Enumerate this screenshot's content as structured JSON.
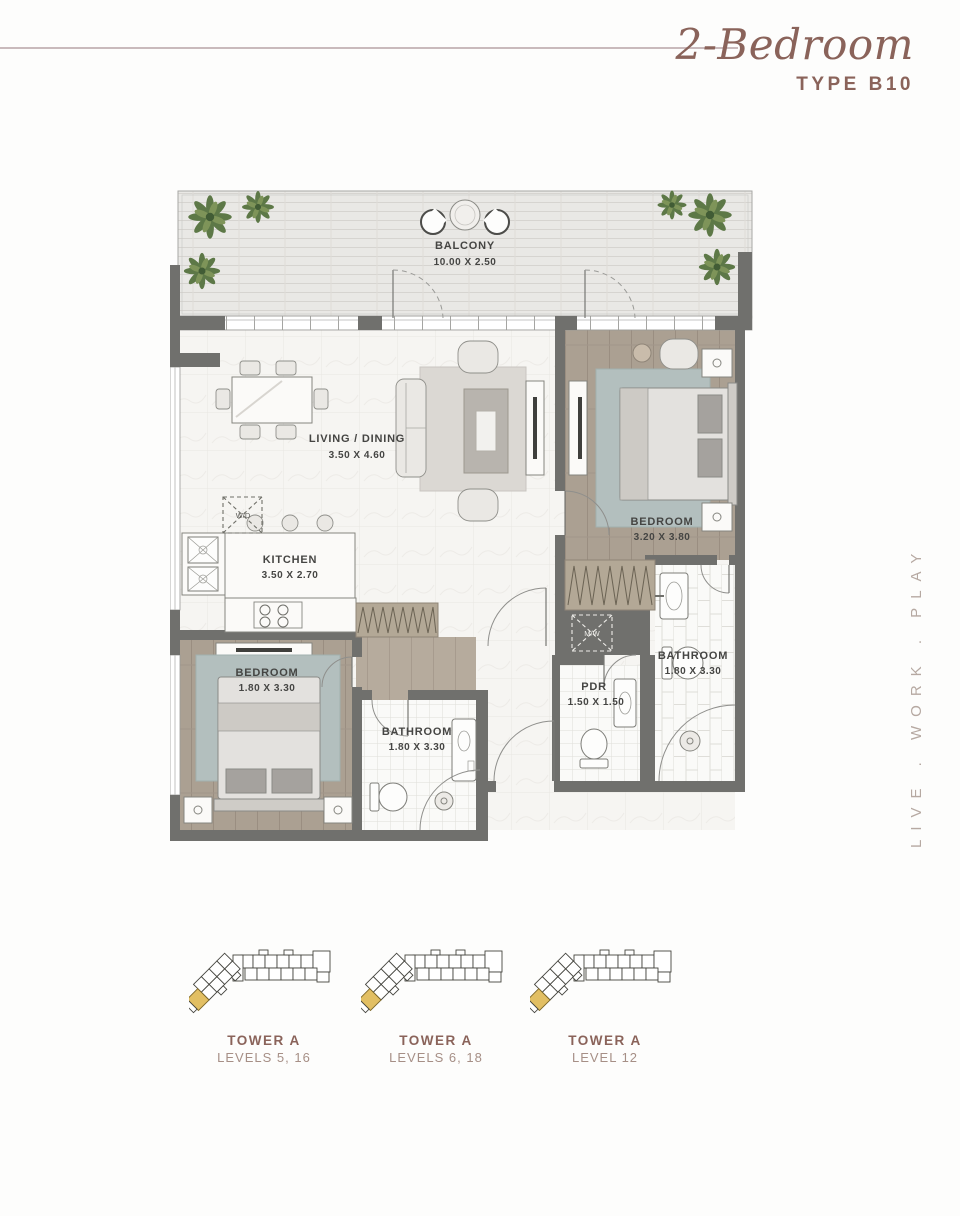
{
  "header": {
    "title": "2-Bedroom",
    "subtitle": "TYPE B10"
  },
  "colors": {
    "accent": "#8a635a",
    "accent_light": "#a68f86",
    "tagline": "#b6a9a2",
    "header_rule": "#c9babc",
    "wall": "#70706d",
    "unit_highlight": "#e2bf63"
  },
  "floorplan": {
    "balcony": {
      "name": "BALCONY",
      "dims": "10.00 X 2.50"
    },
    "living": {
      "name": "LIVING / DINING",
      "dims": "3.50 X 4.60"
    },
    "kitchen": {
      "name": "KITCHEN",
      "dims": "3.50 X 2.70"
    },
    "bedroom_main": {
      "name": "BEDROOM",
      "dims": "3.20 X 3.80"
    },
    "bedroom_second": {
      "name": "BEDROOM",
      "dims": "1.80 X 3.30"
    },
    "bathroom_main": {
      "name": "BATHROOM",
      "dims": "1.80 X 3.30"
    },
    "bathroom_second": {
      "name": "BATHROOM",
      "dims": "1.80 X 3.30"
    },
    "pdr": {
      "name": "PDR",
      "dims": "1.50 X 1.50"
    },
    "washer_dryer": "W/D",
    "microwave": "M/W"
  },
  "sidebar": {
    "tagline": "LIVE . WORK . PLAY"
  },
  "keyplans": [
    {
      "tower": "TOWER A",
      "levels": "LEVELS 5, 16"
    },
    {
      "tower": "TOWER A",
      "levels": "LEVELS 6, 18"
    },
    {
      "tower": "TOWER A",
      "levels": "LEVEL 12"
    }
  ]
}
